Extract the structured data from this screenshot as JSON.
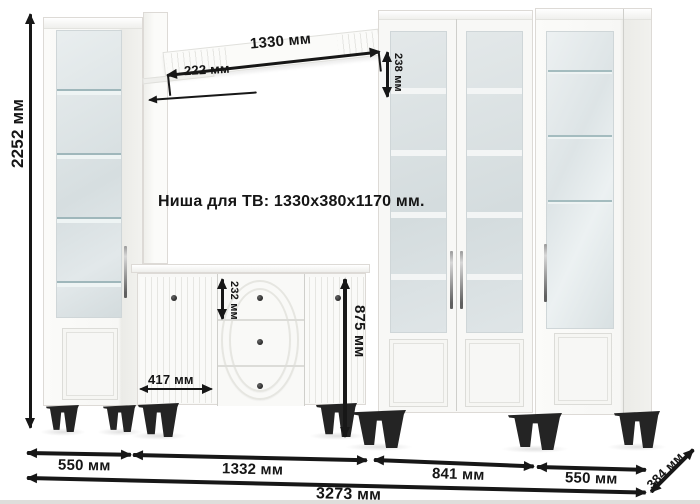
{
  "note": {
    "tv_niche": "Ниша для ТВ: 1330x380x1170 мм."
  },
  "dims": {
    "total_height": "2252 мм",
    "shelf_length": "1330 мм",
    "shelf_inset": "222 мм",
    "shelf_face_height": "238 мм",
    "top_drawer_height": "232 мм",
    "tv_stand_height": "875 мм",
    "tv_stand_door_width": "417 мм",
    "left_cabinet_width": "550 мм",
    "tv_section_width": "1332 мм",
    "bookcase_width": "841 мм",
    "right_cabinet_width": "550 мм",
    "total_width": "3273 мм",
    "depth": "384 мм"
  },
  "colors": {
    "dimension_ink": "#171717",
    "furniture_white": "#f8f8f6",
    "glass_tint": "#d9e0e2",
    "legs_black": "#242424"
  }
}
